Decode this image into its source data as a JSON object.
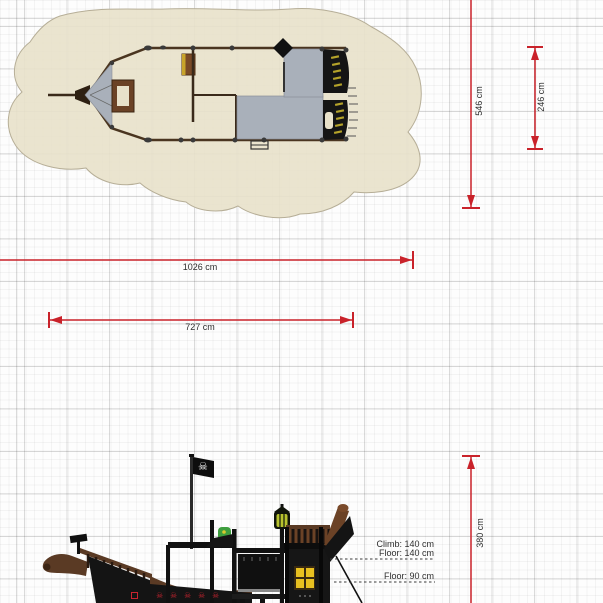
{
  "dimensions": {
    "overall_length": "1026 cm",
    "deck_length": "727 cm",
    "overall_width": "546 cm",
    "deck_width": "246 cm",
    "overall_height": "380 cm"
  },
  "height_labels": {
    "climb": "Climb: 140 cm",
    "floor_upper": "Floor: 140 cm",
    "floor_lower": "Floor: 90 cm"
  },
  "icons": {
    "pirate_flag": "skull-and-crossbones",
    "skull_glyph": "☠"
  },
  "colors": {
    "dimension_red": "#c9222a",
    "sand_beige": "#e8e1ca",
    "deck_gray": "#a9b0ba",
    "hull_black": "#151515",
    "wood_brown": "#5a3a24",
    "window_yellow": "#e8c020",
    "slide_green": "#3e9e3e",
    "emblem_red": "#c8242f"
  }
}
